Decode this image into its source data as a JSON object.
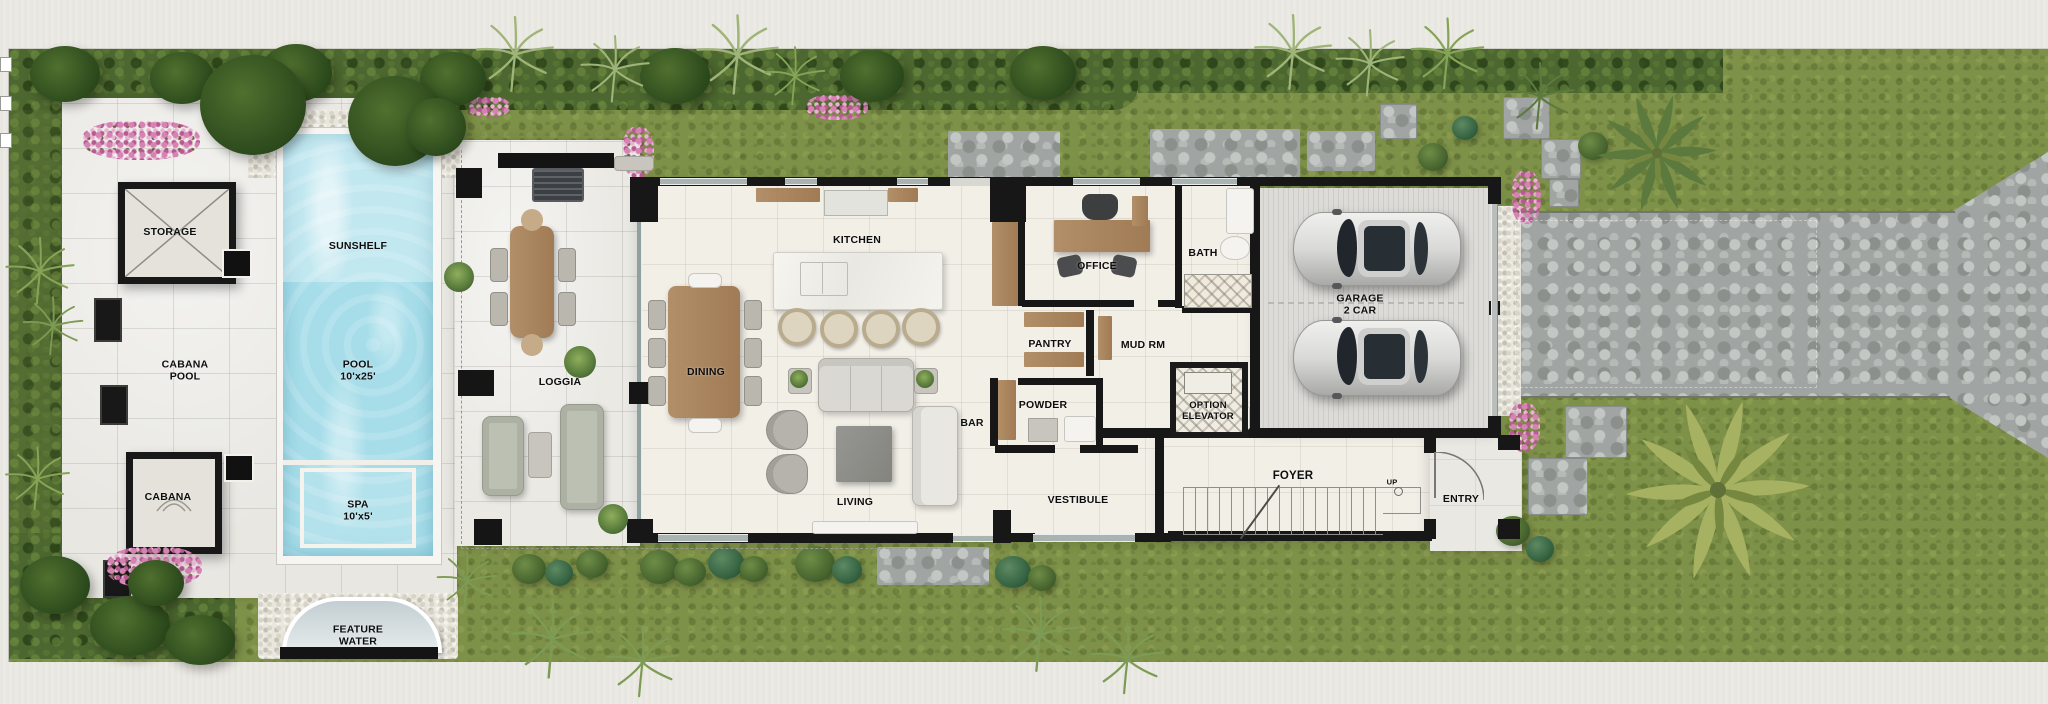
{
  "rooms": {
    "storage": "STORAGE",
    "cabana_pool": "CABANA\nPOOL",
    "sunshelf": "SUNSHELF",
    "pool": "POOL\n10'x25'",
    "cabana": "CABANA",
    "spa": "SPA\n10'x5'",
    "feature_water": "FEATURE\nWATER",
    "loggia": "LOGGIA",
    "dining": "DINING",
    "kitchen": "KITCHEN",
    "living": "LIVING",
    "bar": "BAR",
    "pantry": "PANTRY",
    "powder": "POWDER",
    "vestibule": "VESTIBULE",
    "office": "OFFICE",
    "bath": "BATH",
    "mud_room": "MUD RM",
    "option_elevator": "OPTION\nELEVATOR",
    "garage": "GARAGE\n2 CAR",
    "foyer": "FOYER",
    "entry": "ENTRY",
    "stair_direction": "UP"
  },
  "colors": {
    "grass": "#7e9148",
    "hedge": "#4c672f",
    "deck": "#e8e7e2",
    "house_floor": "#f2efe7",
    "wall": "#171717",
    "pool_water": "#a6dde9",
    "wood": "#b28f68",
    "stone_drive": "#a0a4a2",
    "garage_floor": "#dcdbd7",
    "flower_pink": "#d583b3",
    "palm_green": "#a6b262",
    "car_body": "#d9d9d7"
  }
}
